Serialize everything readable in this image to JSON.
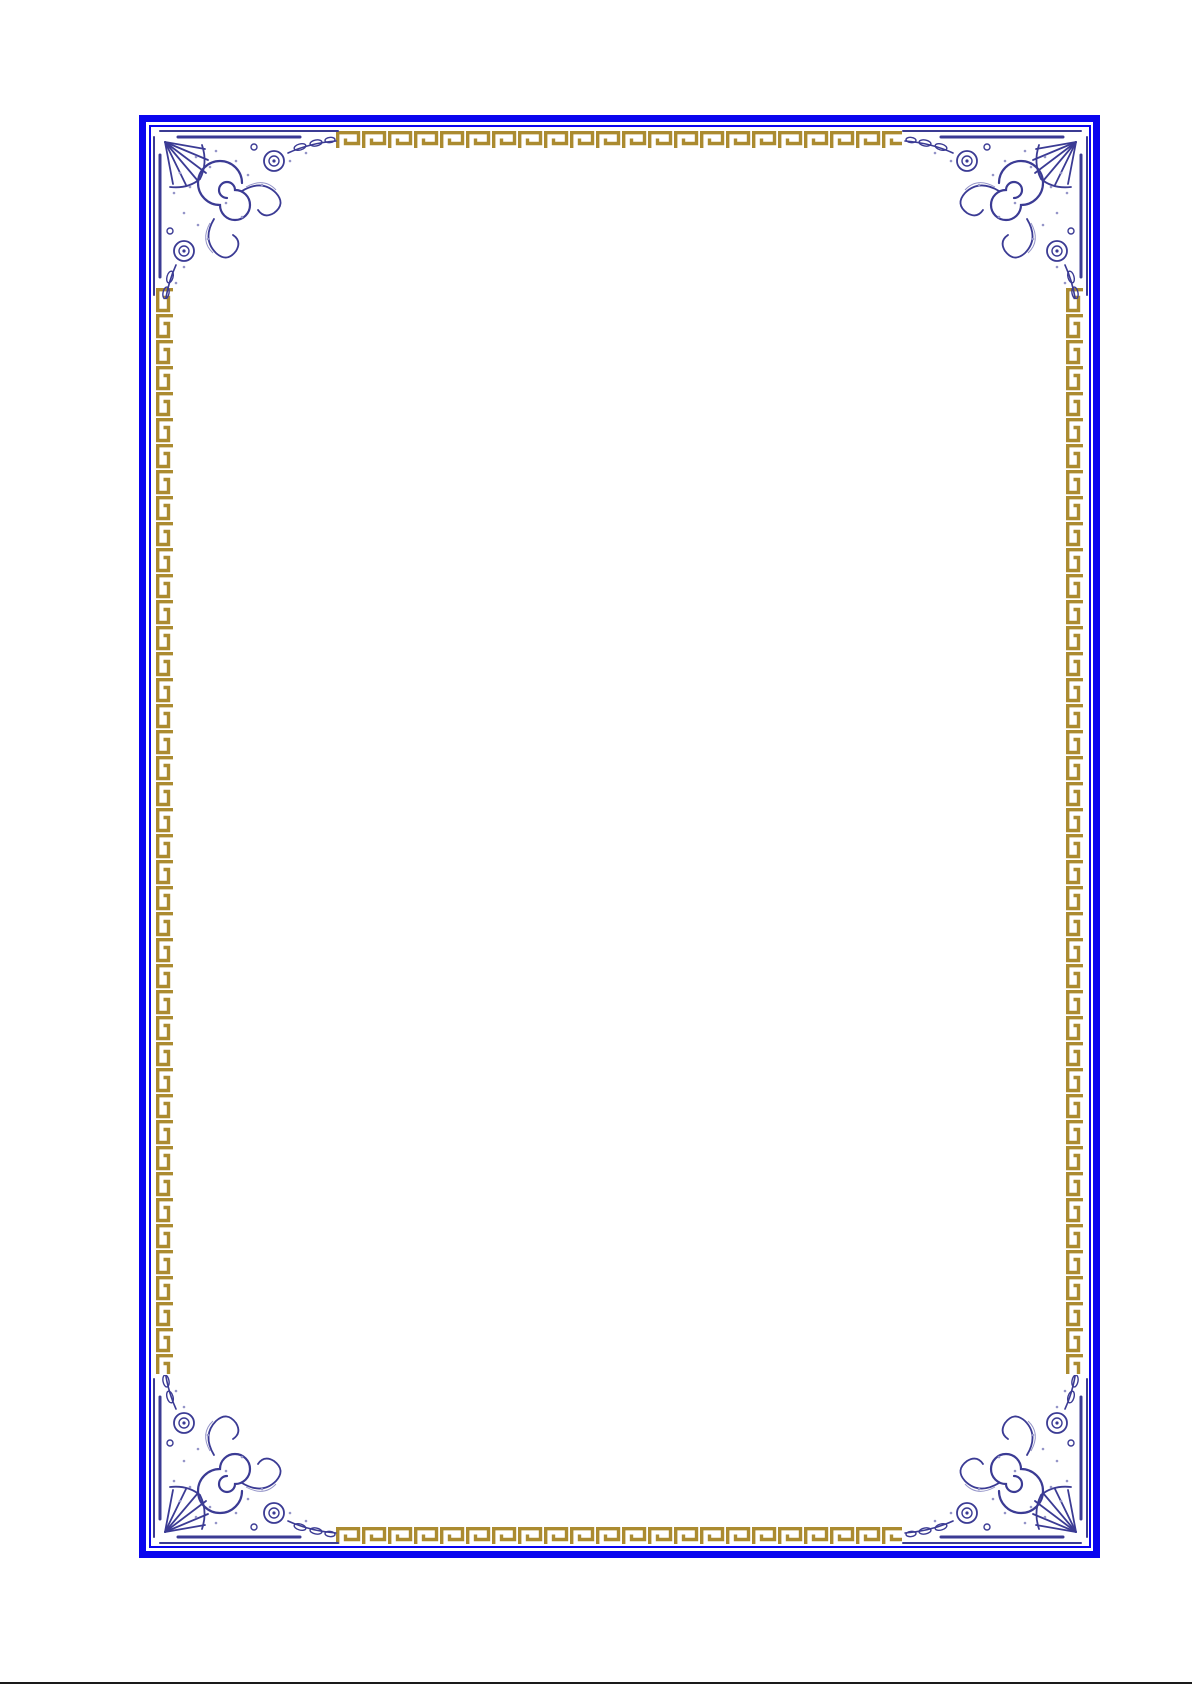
{
  "meta": {
    "page_type": "decorative-certificate-border",
    "description": "Blank certificate / document page with ornate double blue frame, gold Greek-key meander strips and engraved floral corner ornaments",
    "body_text": ""
  },
  "colors": {
    "page-background": "#ffffff",
    "border-blue": "#0a05ef",
    "greek-key-gold": "#ab8b30",
    "ornament-navy": "#3b3b94",
    "ornament-lavender": "#9595c8",
    "bottom-rule": "#1a1a1a"
  },
  "frame": {
    "outer_border": "thick solid blue rectangle",
    "inner_border": "thin solid blue rectangle",
    "pattern_name": "greek-key-meander",
    "corner_ornament_name": "floral-engraving-flourish",
    "corner_count": 4
  }
}
